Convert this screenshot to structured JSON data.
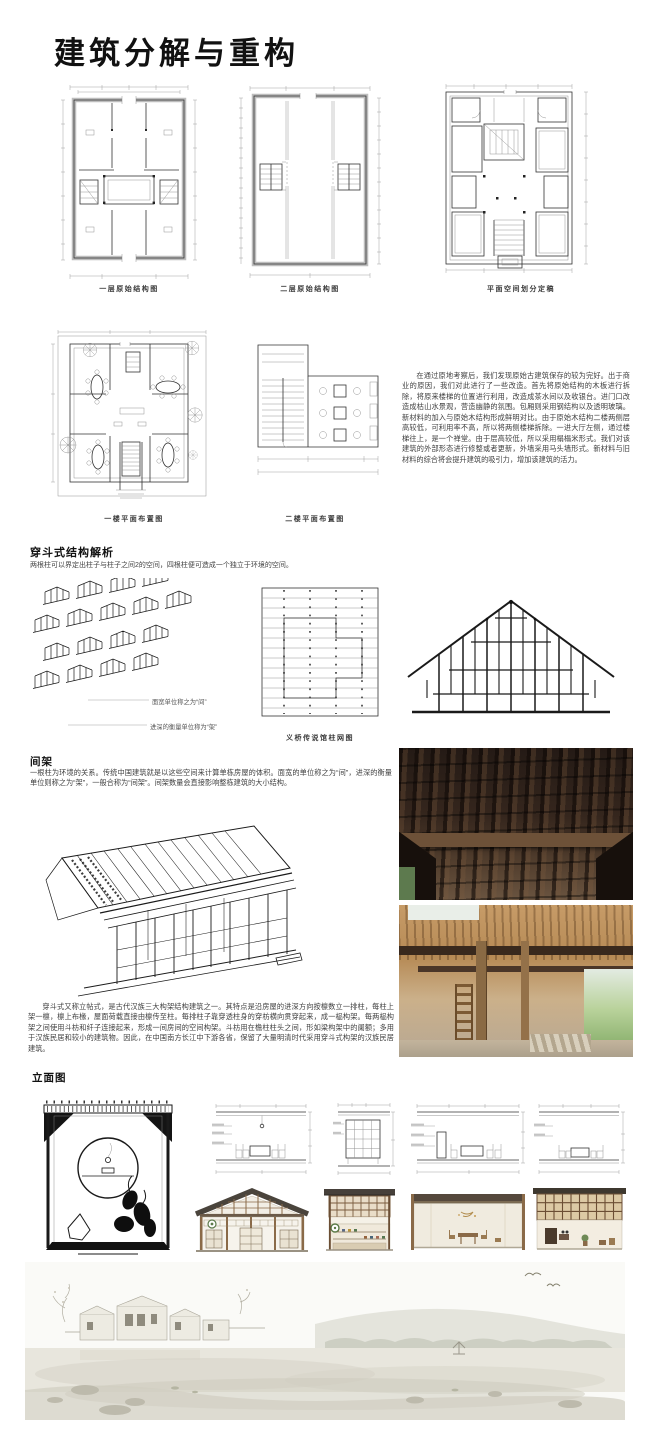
{
  "title": "建筑分解与重构",
  "row1": {
    "captions": [
      "一层原始结构图",
      "二层原始结构图",
      "平面空间划分定稿"
    ]
  },
  "row2": {
    "captions": [
      "一楼平面布置图",
      "二楼平面布置图"
    ],
    "paragraph": "在通过原地考察后，我们发现原始古建筑保存的较为完好。出于商业的原因，我们对此进行了一些改造。首先将原始结构的木板进行拆除，将原来楼梯的位置进行利用，改造成茶水间以及收银台。进门口改造成枯山水景观，营造幽静的氛围。包厢则采用钢结构以及透明玻璃。新材料的加入与原始木结构形成鲜明对比。由于原始木结构二楼两侧层高较低，可利用率不高，所以将两侧楼梯拆除。一进大厅左侧，通过楼梯往上，是一个禅堂。由于层高较低，所以采用榻榻米形式。我们对该建筑的外部形态进行修整或者更新，外墙采用马头墙形式。新材料与旧材料的综合将会提升建筑的吸引力，增加该建筑的活力。"
  },
  "chuandou": {
    "heading": "穿斗式结构解析",
    "subtitle": "两根柱可以界定出柱子与柱子之间2的空间，四根柱便可造成一个独立于环境的空间。",
    "label_jian": "面宽单位称之为“间”",
    "label_jia": "进深的衡量单位称为“架”",
    "grid_caption": "义桥传说馆柱网图"
  },
  "jianjia": {
    "heading": "间架",
    "paragraph": "一根柱为环境的关系。传统中国建筑就是以这些空间来计算单栋房屋的体积。面宽的单位称之为“间”，进深的衡量单位则称之为“架”，一般合称为“间架”。间架数量会直接影响整栋建筑的大小结构。"
  },
  "chuandou_desc": "穿斗式又称立帖式，是古代汉族三大构架结构建筑之一。其特点是沿房屋的进深方向按檩数立一排柱，每柱上架一檩，檩上布椽，屋面荷载直接由檩传至柱。每排柱子靠穿透柱身的穿枋横向贯穿起来，成一榀构架。每两榀构架之间使用斗枋和纤子连接起来，形成一间房间的空间构架。斗枋用在檐柱柱头之间，形如梁构架中的阑额；多用于汉族民居和较小的建筑物。因此，在中国南方长江中下游各省，保留了大量明清时代采用穿斗式构架的汉族民居建筑。",
  "elevation": {
    "heading": "立面图"
  },
  "colors": {
    "wall_poche": "#bdbdbd",
    "photo1_beam": "#6d5138",
    "photo2_beam": "#39291d",
    "render_roof": "#4a443c",
    "render_wood": "#8a6a48",
    "render_wall": "#f1ede4"
  }
}
